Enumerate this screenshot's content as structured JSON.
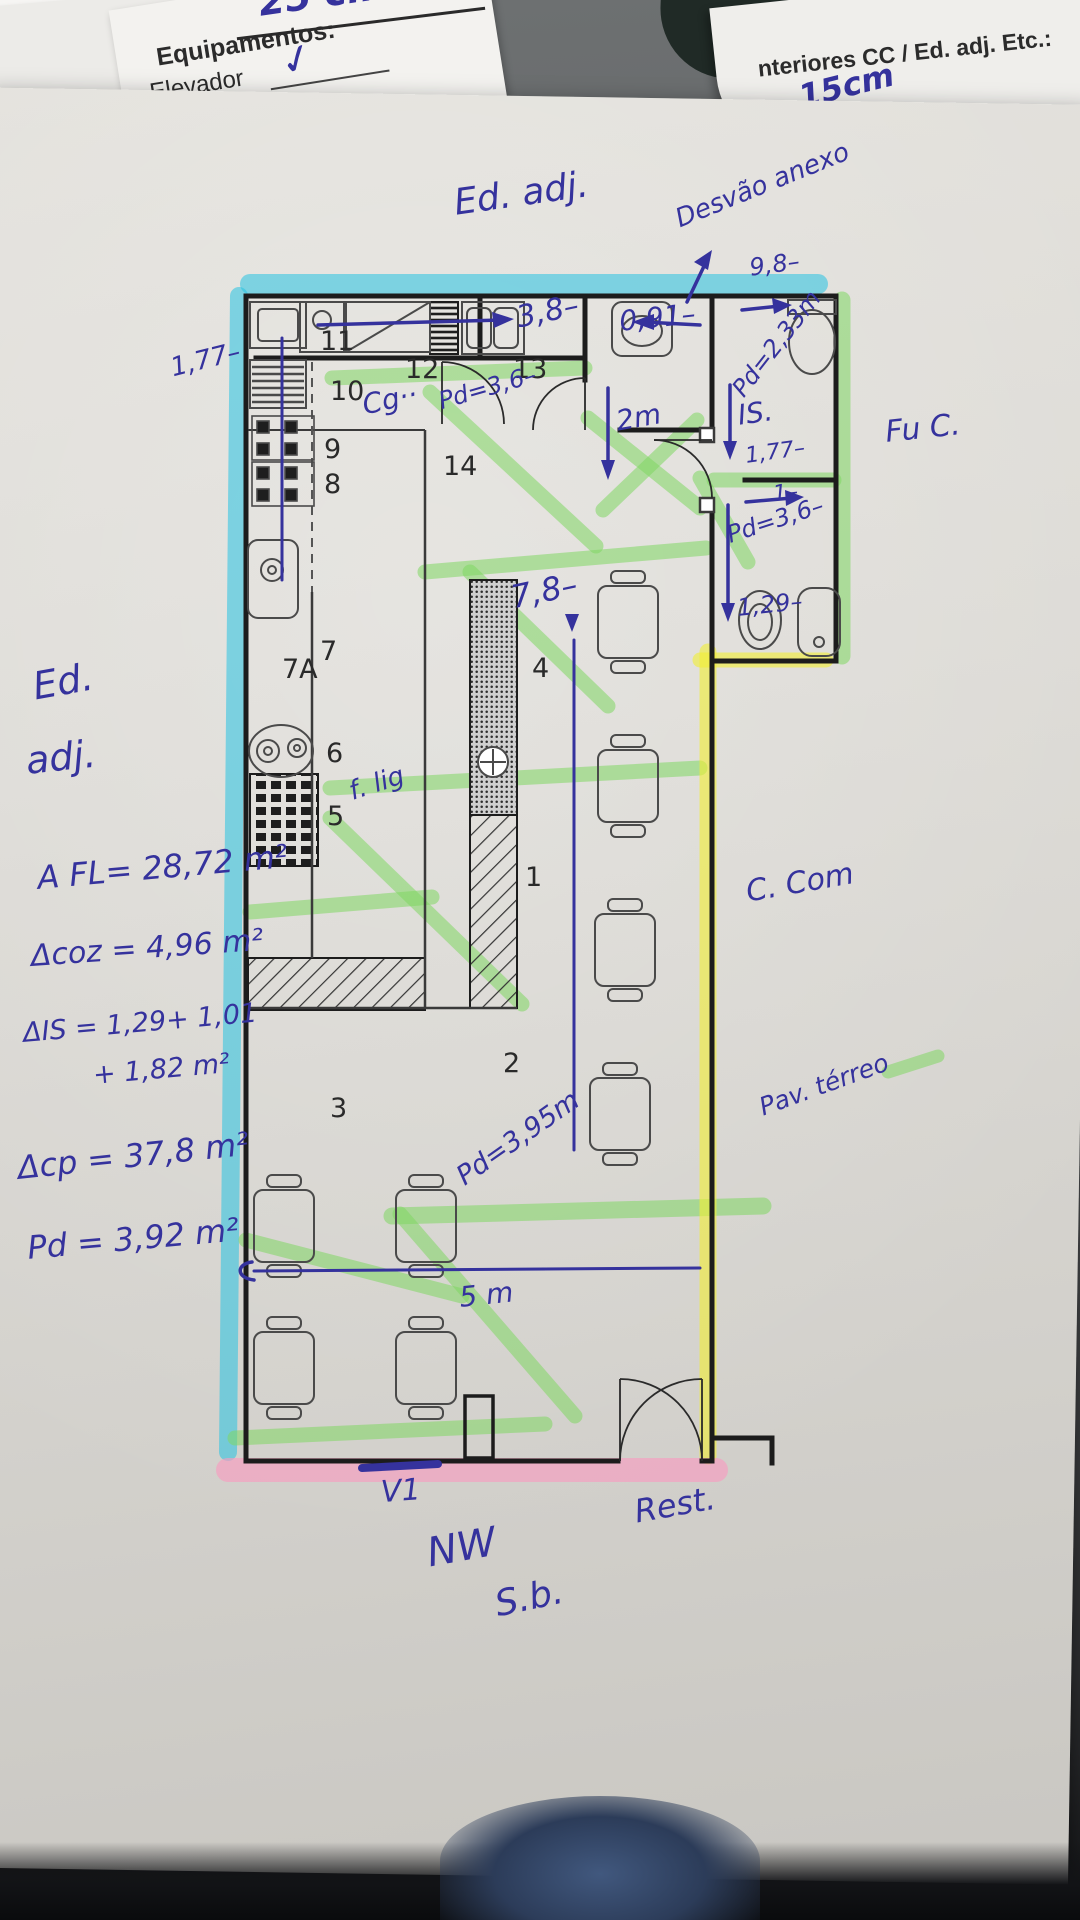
{
  "header_left": {
    "top_note": "25 cm",
    "title": "Equipamentos:",
    "line2": "Elevador",
    "check": "✓",
    "line3": "Rede de C"
  },
  "header_right": {
    "title": "nteriores CC / Ed. adj. Etc.:",
    "label": "ra:",
    "value": "15cm"
  },
  "plan": {
    "rooms": {
      "r1": "1",
      "r2": "2",
      "r3": "3",
      "r4": "4",
      "r5": "5",
      "r6": "6",
      "r7": "7",
      "r7a": "7A",
      "r8": "8",
      "r9": "9",
      "r10": "10",
      "r11": "11",
      "r12": "12",
      "r13": "13",
      "r14": "14"
    }
  },
  "annotations": {
    "ed_adj_top": "Ed. adj.",
    "desvao": "Desvão anexo",
    "d98": "9,8–",
    "d38": "3,8–",
    "d091": "0,91–",
    "pd233": "Pd=2,33m",
    "d2m": "2m",
    "is_label": "IS.",
    "d177r": "1,77–",
    "one": "1–",
    "pd36r": "Pd=3,6–",
    "d129": "1,29–",
    "cg": "Cg··",
    "pd36k": "Pd=3,6–",
    "d177l": "1,77–",
    "d78": "7,8–",
    "flig": "f. lig",
    "ed_left_1": "Ed.",
    "ed_left_2": "adj.",
    "a_fl": "A FL= 28,72 m²",
    "a_coz": "Δcoz = 4,96 m²",
    "a_is_1": "ΔIS = 1,29+ 1,01",
    "a_is_2": "+ 1,82 m²",
    "a_cp": "Δcp =  37,8 m²",
    "pd_bottom": "Pd = 3,92 m²",
    "fu_c": "Fu C.",
    "c_com": "C. Com",
    "pav_terreo": "Pav. térreo",
    "pd395": "Pd=3,95m",
    "d5m": "5 m",
    "v1": "V1",
    "rest": "Rest.",
    "nw": "NW",
    "sb": "S.b."
  },
  "colors": {
    "pen_blue": "#35329d",
    "highlight_cyan": "#27c2e2",
    "highlight_green": "#7fd763",
    "highlight_yellow": "#f2ee33",
    "highlight_pink": "#f79cc0",
    "folder_teal": "#202a26",
    "wall_black": "#1c1c1c"
  }
}
